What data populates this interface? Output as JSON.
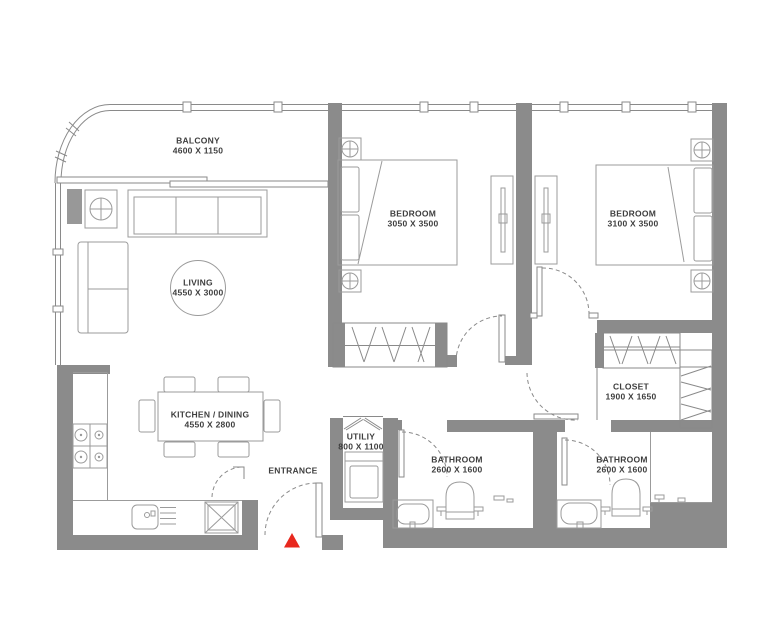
{
  "plan": {
    "type": "apartment-floor-plan",
    "rooms": [
      {
        "id": "balcony",
        "label": "BALCONY",
        "dims": "4600 X 1150"
      },
      {
        "id": "living",
        "label": "LIVING",
        "dims": "4550 X 3000"
      },
      {
        "id": "bedroom-1",
        "label": "BEDROOM",
        "dims": "3050 X 3500"
      },
      {
        "id": "bedroom-2",
        "label": "BEDROOM",
        "dims": "3100 X 3500"
      },
      {
        "id": "kitchen-dining",
        "label": "KITCHEN  / DINING",
        "dims": "4550 X 2800"
      },
      {
        "id": "closet",
        "label": "CLOSET",
        "dims": "1900 X 1650"
      },
      {
        "id": "utility",
        "label": "UTILIY",
        "dims": "800 X 1100"
      },
      {
        "id": "bathroom-1",
        "label": "BATHROOM",
        "dims": "2600 X 1600"
      },
      {
        "id": "bathroom-2",
        "label": "BATHROOM",
        "dims": "2600 X 1600"
      }
    ],
    "entrance_label": "ENTRANCE",
    "colors": {
      "wall": "#8b8b8b",
      "line": "#8a8a8a",
      "furniture_line": "#9b9b9b",
      "text": "#3e3e3e",
      "entrance_marker": "#e8281e",
      "background": "#ffffff"
    }
  }
}
